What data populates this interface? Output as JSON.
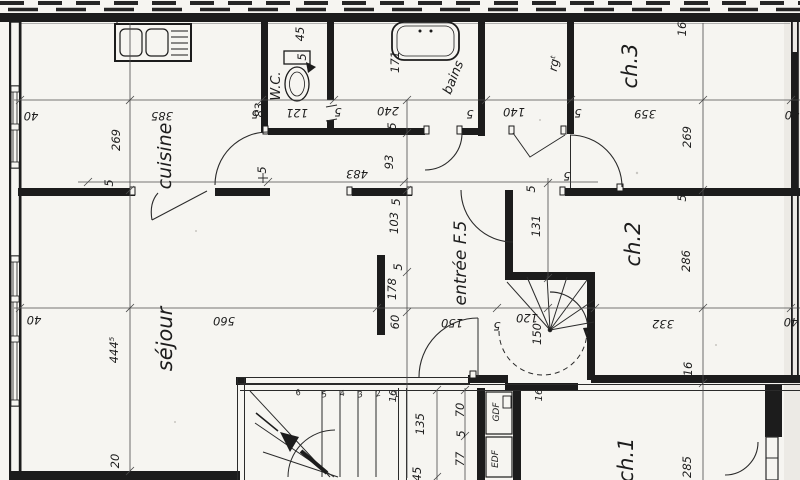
{
  "colors": {
    "paper": "#f6f5f1",
    "ink": "#1c1c1c",
    "dim_line": "#4a4a4a"
  },
  "plan_type": "apartment-floor-plan",
  "rooms": [
    {
      "t": "cuisine",
      "x": 171,
      "y": 156,
      "r": -90,
      "s": 19
    },
    {
      "t": "W.C.",
      "x": 280,
      "y": 86,
      "r": -90,
      "s": 13
    },
    {
      "t": "bains",
      "x": 457,
      "y": 79,
      "r": -68,
      "s": 13
    },
    {
      "t": "rgᵗ",
      "x": 558,
      "y": 64,
      "r": -80,
      "s": 12
    },
    {
      "t": "ch.3",
      "x": 637,
      "y": 66,
      "r": -90,
      "s": 21
    },
    {
      "t": "ch.2",
      "x": 640,
      "y": 244,
      "r": -90,
      "s": 21
    },
    {
      "t": "ch.1",
      "x": 633,
      "y": 460,
      "r": -90,
      "s": 21
    },
    {
      "t": "séjour",
      "x": 172,
      "y": 339,
      "r": -90,
      "s": 21
    },
    {
      "t": "entrée F.5",
      "x": 466,
      "y": 263,
      "r": -90,
      "s": 17
    },
    {
      "t": "GDF",
      "x": 499,
      "y": 412,
      "r": -90,
      "s": 9
    },
    {
      "t": "EDF",
      "x": 498,
      "y": 459,
      "r": -90,
      "s": 9
    }
  ],
  "dimensions": [
    {
      "t": "40",
      "x": 31,
      "y": 112,
      "r": 180
    },
    {
      "t": "269",
      "x": 120,
      "y": 140,
      "r": -90
    },
    {
      "t": "5",
      "x": 113,
      "y": 183,
      "r": -90
    },
    {
      "t": "385",
      "x": 162,
      "y": 112,
      "r": 180
    },
    {
      "t": "5",
      "x": 255,
      "y": 110,
      "r": 180
    },
    {
      "t": "83",
      "x": 263,
      "y": 110,
      "r": -90
    },
    {
      "t": "121",
      "x": 297,
      "y": 109,
      "r": 180
    },
    {
      "t": "5",
      "x": 338,
      "y": 108,
      "r": 180
    },
    {
      "t": "240",
      "x": 388,
      "y": 107,
      "r": 180
    },
    {
      "t": "5",
      "x": 396,
      "y": 126,
      "r": -90
    },
    {
      "t": "171",
      "x": 399,
      "y": 62,
      "r": -90
    },
    {
      "t": "45",
      "x": 304,
      "y": 34,
      "r": -90
    },
    {
      "t": "5",
      "x": 306,
      "y": 57,
      "r": -90
    },
    {
      "t": "5",
      "x": 470,
      "y": 110,
      "r": 180
    },
    {
      "t": "140",
      "x": 514,
      "y": 108,
      "r": 180
    },
    {
      "t": "5",
      "x": 578,
      "y": 109,
      "r": 180
    },
    {
      "t": "359",
      "x": 645,
      "y": 110,
      "r": 180
    },
    {
      "t": "269",
      "x": 691,
      "y": 137,
      "r": -90
    },
    {
      "t": "16",
      "x": 686,
      "y": 29,
      "r": -90
    },
    {
      "t": "40",
      "x": 792,
      "y": 111,
      "r": 180
    },
    {
      "t": "5",
      "x": 266,
      "y": 170,
      "r": -90
    },
    {
      "t": "483",
      "x": 357,
      "y": 170,
      "r": 180
    },
    {
      "t": "93",
      "x": 393,
      "y": 162,
      "r": -90
    },
    {
      "t": "5",
      "x": 535,
      "y": 189,
      "r": -90
    },
    {
      "t": "131",
      "x": 540,
      "y": 226,
      "r": -90
    },
    {
      "t": "5",
      "x": 567,
      "y": 172,
      "r": 180
    },
    {
      "t": "103",
      "x": 398,
      "y": 223,
      "r": -90
    },
    {
      "t": "5",
      "x": 400,
      "y": 202,
      "r": -90
    },
    {
      "t": "178",
      "x": 396,
      "y": 289,
      "r": -90
    },
    {
      "t": "5",
      "x": 402,
      "y": 267,
      "r": -90
    },
    {
      "t": "60",
      "x": 399,
      "y": 322,
      "r": -90
    },
    {
      "t": "40",
      "x": 34,
      "y": 316,
      "r": 180
    },
    {
      "t": "560",
      "x": 224,
      "y": 317,
      "r": 180
    },
    {
      "t": "444⁵",
      "x": 118,
      "y": 350,
      "r": -90
    },
    {
      "t": "150",
      "x": 452,
      "y": 319,
      "r": 180
    },
    {
      "t": "5",
      "x": 497,
      "y": 322,
      "r": 180
    },
    {
      "t": "120",
      "x": 527,
      "y": 314,
      "r": 180
    },
    {
      "t": "150",
      "x": 541,
      "y": 334,
      "r": -90
    },
    {
      "t": "332",
      "x": 663,
      "y": 320,
      "r": 180
    },
    {
      "t": "40",
      "x": 791,
      "y": 318,
      "r": 180
    },
    {
      "t": "16",
      "x": 692,
      "y": 369,
      "r": -90
    },
    {
      "t": "5",
      "x": 686,
      "y": 198,
      "r": -90
    },
    {
      "t": "286",
      "x": 690,
      "y": 261,
      "r": -90
    },
    {
      "t": "285",
      "x": 691,
      "y": 467,
      "r": -90
    },
    {
      "t": "20",
      "x": 119,
      "y": 461,
      "r": -90
    },
    {
      "t": "16",
      "x": 396,
      "y": 396,
      "r": -90,
      "s": 10
    },
    {
      "t": "135",
      "x": 424,
      "y": 424,
      "r": -90
    },
    {
      "t": "45",
      "x": 421,
      "y": 474,
      "r": -90
    },
    {
      "t": "70",
      "x": 464,
      "y": 410,
      "r": -90
    },
    {
      "t": "5",
      "x": 465,
      "y": 434,
      "r": -90
    },
    {
      "t": "77",
      "x": 464,
      "y": 459,
      "r": -90
    },
    {
      "t": "16",
      "x": 542,
      "y": 395,
      "r": -90,
      "s": 10
    },
    {
      "t": "1",
      "x": 397,
      "y": 397,
      "r": -15,
      "s": 8
    },
    {
      "t": "2",
      "x": 379,
      "y": 396,
      "r": -15,
      "s": 8
    },
    {
      "t": "3",
      "x": 361,
      "y": 397,
      "r": -15,
      "s": 8
    },
    {
      "t": "4",
      "x": 343,
      "y": 396,
      "r": -15,
      "s": 8
    },
    {
      "t": "5",
      "x": 325,
      "y": 397,
      "r": -15,
      "s": 8
    },
    {
      "t": "6",
      "x": 299,
      "y": 395,
      "r": -20,
      "s": 8
    }
  ]
}
